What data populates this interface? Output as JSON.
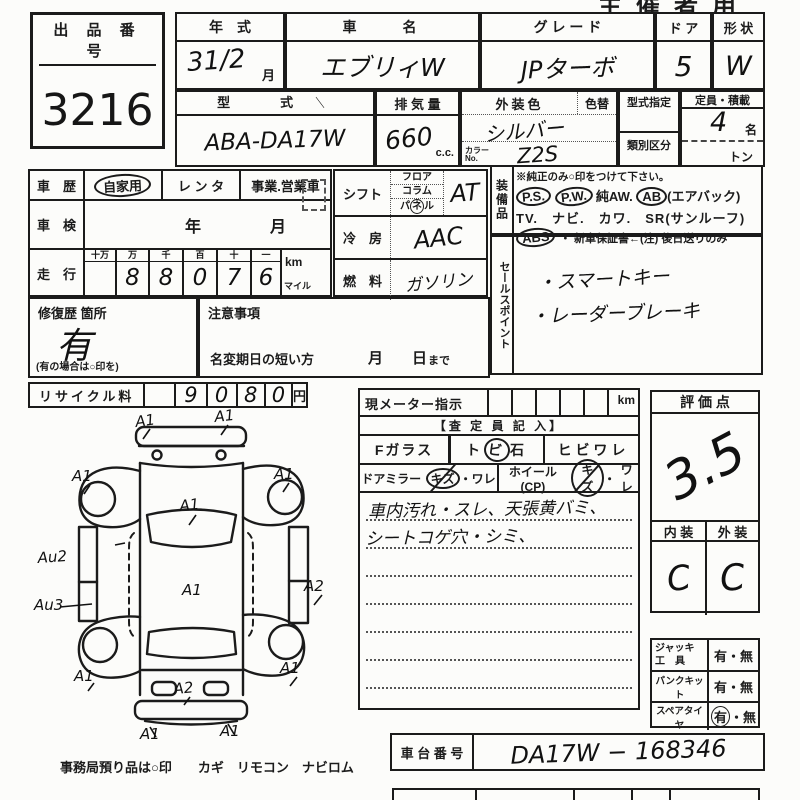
{
  "sheet": {
    "top_right_label": "主催者用"
  },
  "lot": {
    "label": "出 品 番 号",
    "number": "3216"
  },
  "row1": {
    "year_label": "年　式",
    "year_value": "31/2",
    "year_unit": "月",
    "name_label": "車　　名",
    "name_value": "エブリィW",
    "grade_label": "グ レ ー ド",
    "grade_value": "JPターボ",
    "door_label": "ド ア",
    "door_value": "5",
    "shape_label": "形 状",
    "shape_value": "W"
  },
  "row2": {
    "model_label": "型　　式",
    "model_mark": "＼",
    "model_value": "ABA-DA17W",
    "disp_label": "排 気 量",
    "disp_value": "660",
    "disp_unit": "c.c.",
    "color_label": "外装色",
    "color_change_label": "色替",
    "color_value": "シルバー",
    "color_no_label_1": "カラー",
    "color_no_label_2": "No.",
    "color_no_value": "Z2S",
    "type_desig_label": "型式指定",
    "class_label": "類別区分",
    "capacity_label": "定員・積載",
    "capacity_value": "4",
    "capacity_unit": "名",
    "ton_label": "トン"
  },
  "history": {
    "label": "車　歴",
    "private": "自家用",
    "rental": "レ ン タ",
    "business": "事業.営業車"
  },
  "inspection": {
    "label": "車　検",
    "year": "年",
    "month": "月"
  },
  "mileage": {
    "label": "走　行",
    "headers": [
      "十万",
      "万",
      "千",
      "百",
      "十",
      "一"
    ],
    "digits": [
      "",
      "8",
      "8",
      "0",
      "7",
      "6"
    ],
    "unit_km": "km",
    "unit_mile": "マイル"
  },
  "shift": {
    "label": "シフト",
    "opt1": "フロア",
    "opt2": "コラム",
    "opt3_a": "パ",
    "opt3_b": "ネ",
    "opt3_c": "ル",
    "value": "AT"
  },
  "ac": {
    "label": "冷　房",
    "value": "AAC"
  },
  "fuel": {
    "label": "燃　料",
    "value": "ガソリン"
  },
  "equipment": {
    "label": "装備品",
    "note": "※純正のみ○印をつけて下さい。",
    "ps": "P.S.",
    "pw": "P.W.",
    "aw": "純AW.",
    "ab": "AB",
    "ab_suffix": "(エアバック)",
    "line3": "TV.　ナビ.　カワ.　SR(サンルーフ)",
    "abs": "ABS",
    "line4_rest": "・ 新車保証書←(注) 後日送りのみ"
  },
  "sales": {
    "label": "セールスポイント",
    "line1": "・スマートキー",
    "line2": "・レーダーブレーキ"
  },
  "repair": {
    "label": "修復歴 箇所",
    "value": "有",
    "note": "(有の場合は○印を)"
  },
  "caution": {
    "label": "注意事項",
    "name_change": "名変期日の短い方",
    "month": "月",
    "day": "日",
    "made": "まで"
  },
  "recycle": {
    "label": "リサイクル料",
    "d1": "9",
    "d2": "0",
    "d3": "8",
    "d4": "0",
    "unit": "円"
  },
  "assessor": {
    "meter_label": "現メーター指示",
    "meter_unit": "km",
    "section_title": "【査 定 員 記 入】",
    "fglass": "Fガラス",
    "tobi_a": "ト",
    "tobi_b": "ビ",
    "tobi_c": "石",
    "hibiware": "ヒ ビ ワ レ",
    "mirror_label": "ドアミラー",
    "kizu": "キズ",
    "dot": "・",
    "ware": "ワレ",
    "wheel_label": "ホイール(CP)",
    "note1": "車内汚れ・スレ、天張黄バミ、",
    "note2": "シートコゲ穴・シミ、"
  },
  "score": {
    "label": "評  価  点",
    "value": "3.5",
    "interior_label": "内 装",
    "exterior_label": "外 装",
    "interior": "C",
    "exterior": "C"
  },
  "tools": {
    "jack_1": "ジャッキ",
    "jack_2": "工　具",
    "jack_yes": "有",
    "jack_sep": "・",
    "jack_no": "無",
    "pank": "パンクキット",
    "pank_yes": "有",
    "pank_sep": "・",
    "pank_no": "無",
    "spare": "スペアタイヤ",
    "spare_yes": "有",
    "spare_sep": "・",
    "spare_no": "無"
  },
  "chassis": {
    "label": "車 台 番 号",
    "value": "DA17W −  168346"
  },
  "office_note": "事務局預り品は○印　　カギ　リモコン　ナビロム",
  "diagram": {
    "annotations": [
      "A1",
      "A1",
      "A1",
      "A1",
      "A1",
      "A1",
      "Au2",
      "Au3",
      "A2",
      "A1",
      "A1",
      "A2",
      "A1",
      "A1"
    ]
  }
}
